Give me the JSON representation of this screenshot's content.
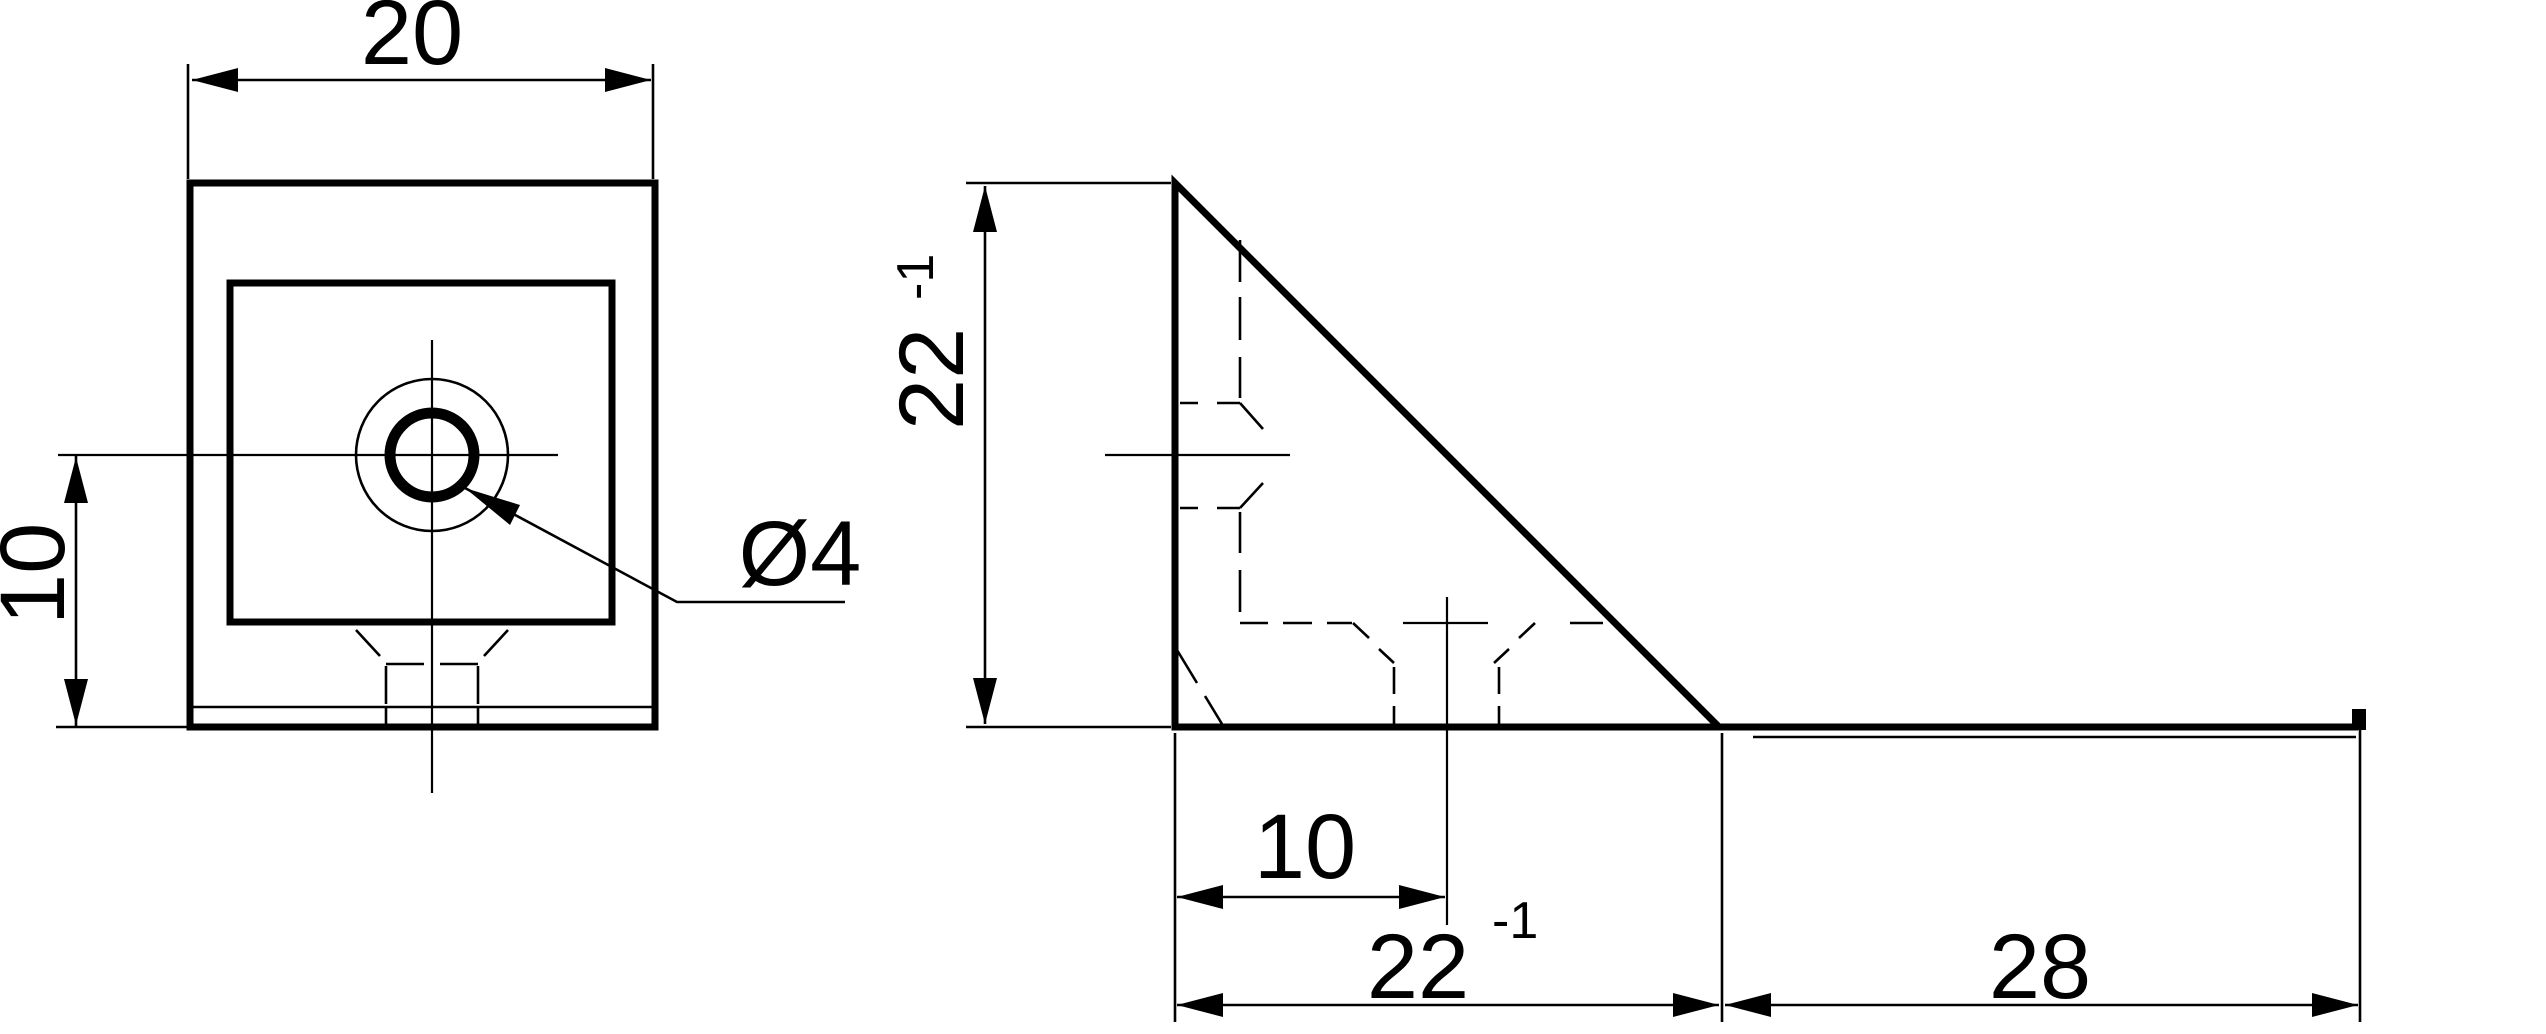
{
  "drawing": {
    "front_view": {
      "width_dim": "20",
      "hole_offset_dim": "10",
      "hole_diameter_label": "Ø4"
    },
    "side_view": {
      "height_dim": "22",
      "height_dim_sup": "-1",
      "hole_offset_dim": "10",
      "base_dim": "22",
      "base_dim_sup": "-1",
      "flange_dim": "28"
    },
    "line_color": "#000000",
    "background_color": "#ffffff"
  }
}
